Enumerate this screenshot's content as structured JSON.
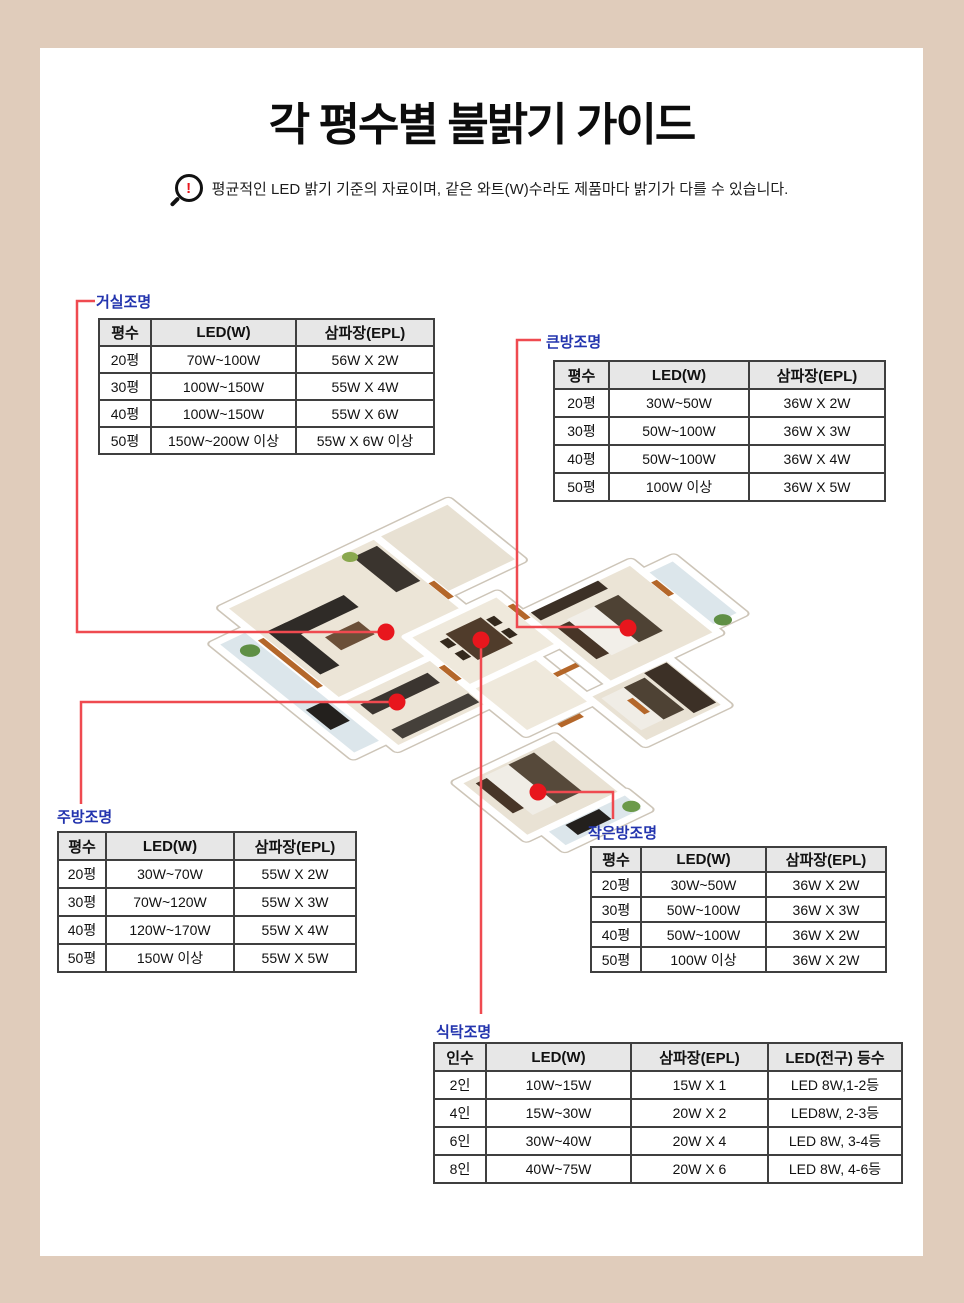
{
  "page": {
    "title": "각 평수별 불밝기 가이드",
    "notice": "평균적인 LED 밝기 기준의 자료이며, 같은 와트(W)수라도 제품마다 밝기가 다를 수 있습니다.",
    "notice_bang": "!"
  },
  "colors": {
    "frame_beige": "#e0ccbb",
    "label_blue": "#2334ae",
    "connector_red": "#ef4a50",
    "dot_red": "#e8161d",
    "table_border": "#3f3f3f",
    "header_bg": "#e7e7e7"
  },
  "tables": {
    "living": {
      "label": "거실조명",
      "headers": [
        "평수",
        "LED(W)",
        "삼파장(EPL)"
      ],
      "rows": [
        [
          "20평",
          "70W~100W",
          "56W X 2W"
        ],
        [
          "30평",
          "100W~150W",
          "55W X 4W"
        ],
        [
          "40평",
          "100W~150W",
          "55W X 6W"
        ],
        [
          "50평",
          "150W~200W 이상",
          "55W X 6W 이상"
        ]
      ]
    },
    "big_room": {
      "label": "큰방조명",
      "headers": [
        "평수",
        "LED(W)",
        "삼파장(EPL)"
      ],
      "rows": [
        [
          "20평",
          "30W~50W",
          "36W X 2W"
        ],
        [
          "30평",
          "50W~100W",
          "36W X 3W"
        ],
        [
          "40평",
          "50W~100W",
          "36W X 4W"
        ],
        [
          "50평",
          "100W 이상",
          "36W X 5W"
        ]
      ]
    },
    "kitchen": {
      "label": "주방조명",
      "headers": [
        "평수",
        "LED(W)",
        "삼파장(EPL)"
      ],
      "rows": [
        [
          "20평",
          "30W~70W",
          "55W X 2W"
        ],
        [
          "30평",
          "70W~120W",
          "55W X 3W"
        ],
        [
          "40평",
          "120W~170W",
          "55W X 4W"
        ],
        [
          "50평",
          "150W 이상",
          "55W X 5W"
        ]
      ]
    },
    "small_room": {
      "label": "작은방조명",
      "headers": [
        "평수",
        "LED(W)",
        "삼파장(EPL)"
      ],
      "rows": [
        [
          "20평",
          "30W~50W",
          "36W X 2W"
        ],
        [
          "30평",
          "50W~100W",
          "36W X 3W"
        ],
        [
          "40평",
          "50W~100W",
          "36W X 2W"
        ],
        [
          "50평",
          "100W 이상",
          "36W X 2W"
        ]
      ]
    },
    "dining": {
      "label": "식탁조명",
      "headers": [
        "인수",
        "LED(W)",
        "삼파장(EPL)",
        "LED(전구) 등수"
      ],
      "rows": [
        [
          "2인",
          "10W~15W",
          "15W X 1",
          "LED 8W,1-2등"
        ],
        [
          "4인",
          "15W~30W",
          "20W X 2",
          "LED8W, 2-3등"
        ],
        [
          "6인",
          "30W~40W",
          "20W X 4",
          "LED 8W, 3-4등"
        ],
        [
          "8인",
          "40W~75W",
          "20W X 6",
          "LED 8W, 4-6등"
        ]
      ]
    }
  }
}
